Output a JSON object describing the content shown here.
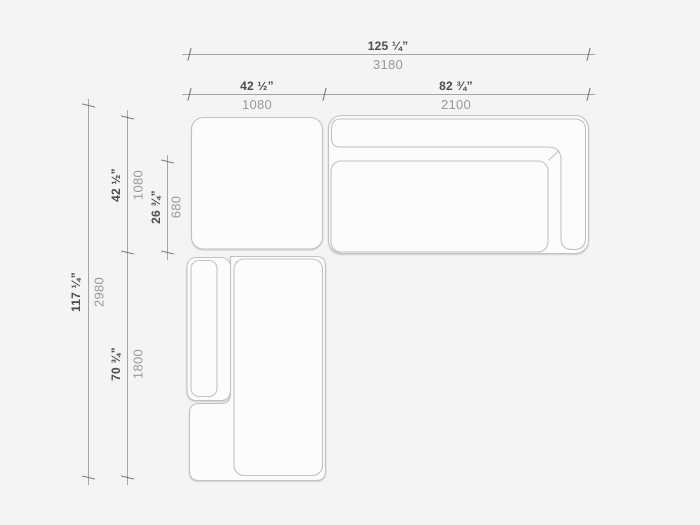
{
  "page": {
    "title": "Sectional sofa plan view with overall and module dimensions"
  },
  "colors": {
    "page_background": "#f4f4f5",
    "outline": "#c2c2c2",
    "dimension_line": "#a6a6a6",
    "tick": "#6f6f6f",
    "inches_text": "#4c4c4c",
    "mm_text": "#999999",
    "module_fill": "#fcfcfc"
  },
  "dimensions": {
    "overall_width": {
      "inches": "125 ¼”",
      "mm": "3180"
    },
    "corner_module_width": {
      "inches": "42 ½”",
      "mm": "1080"
    },
    "sofa_module_width": {
      "inches": "82 ¾”",
      "mm": "2100"
    },
    "overall_depth": {
      "inches": "117 ¼”",
      "mm": "2980"
    },
    "corner_module_depth": {
      "inches": "42 ½”",
      "mm": "1080"
    },
    "seat_depth": {
      "inches": "26 ¾”",
      "mm": "680"
    },
    "chaise_module_length": {
      "inches": "70 ¾”",
      "mm": "1800"
    }
  }
}
